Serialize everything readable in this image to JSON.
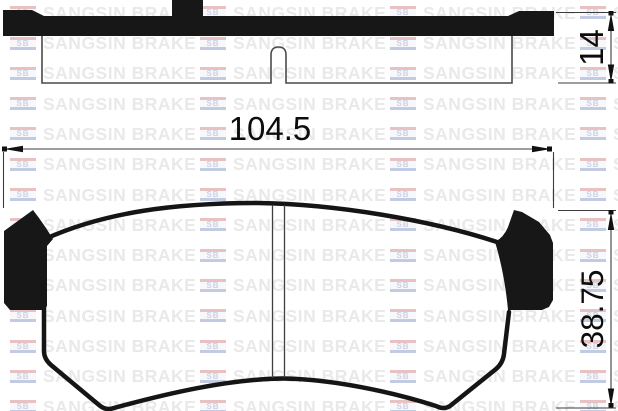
{
  "watermark": {
    "logo_text": "SB",
    "brand_text": "SANGSIN BRAKE"
  },
  "dimensions": {
    "pad_width": "104.5",
    "pad_thickness": "14",
    "pad_height": "38.75"
  },
  "colors": {
    "ink": "#151515",
    "dim_line": "#3c3c3c",
    "background": "#ffffff",
    "watermark_text": "#eae8e8",
    "watermark_red": "#e8c2c2",
    "watermark_blue": "#c2cbe2"
  }
}
